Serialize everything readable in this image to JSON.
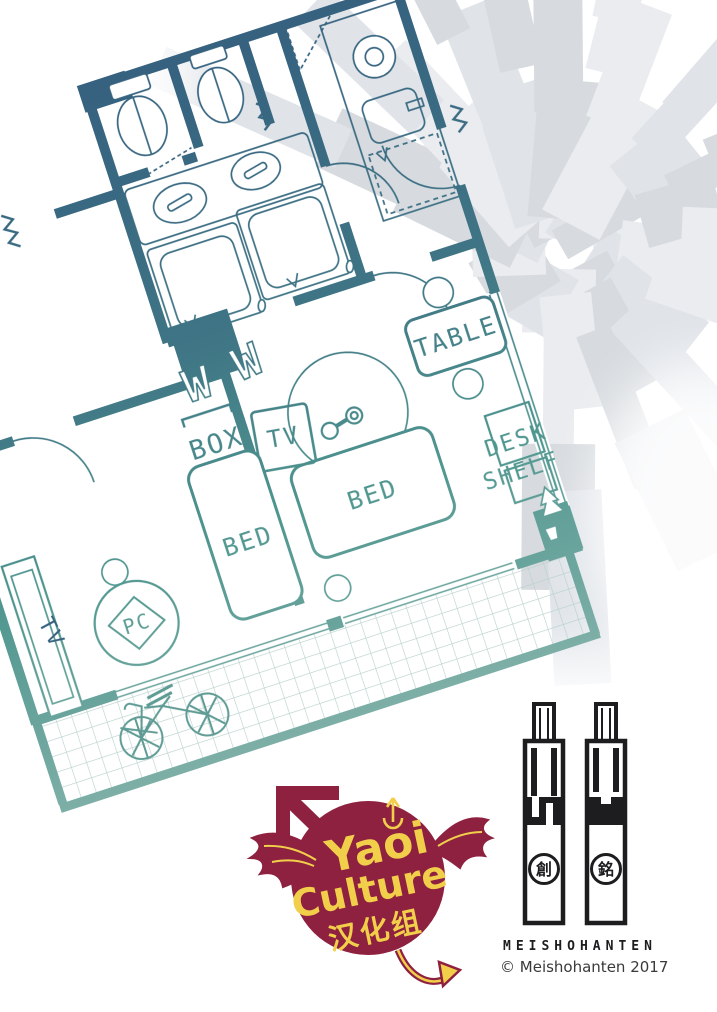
{
  "floor_plan": {
    "labels": {
      "table": "TABLE",
      "box": "BOX",
      "tv_unit": "TV",
      "bed_left": "BED",
      "bed_right": "BED",
      "desk": "DESK",
      "shelf": "SHELF",
      "pc": "PC",
      "tv_wall": "TV",
      "wall_mark_left": "W",
      "wall_mark_right": "W"
    },
    "colors": {
      "wall_dark_blue": "#35607f",
      "wall_teal": "#4f968f",
      "balcony_teal": "#7fb0a8"
    }
  },
  "scanlation_logo": {
    "word_top": "Yaoi",
    "word_mid": "Culture",
    "word_bottom": "汉化组",
    "colors": {
      "badge": "#8e2040",
      "text": "#f2cf4a"
    }
  },
  "publisher": {
    "wordmark": "MEISHOHANTEN",
    "copyright": "© Meishohanten 2017",
    "seal_left_glyph": "創",
    "seal_right_glyph": "銘",
    "ink": "#1d1d1f"
  }
}
